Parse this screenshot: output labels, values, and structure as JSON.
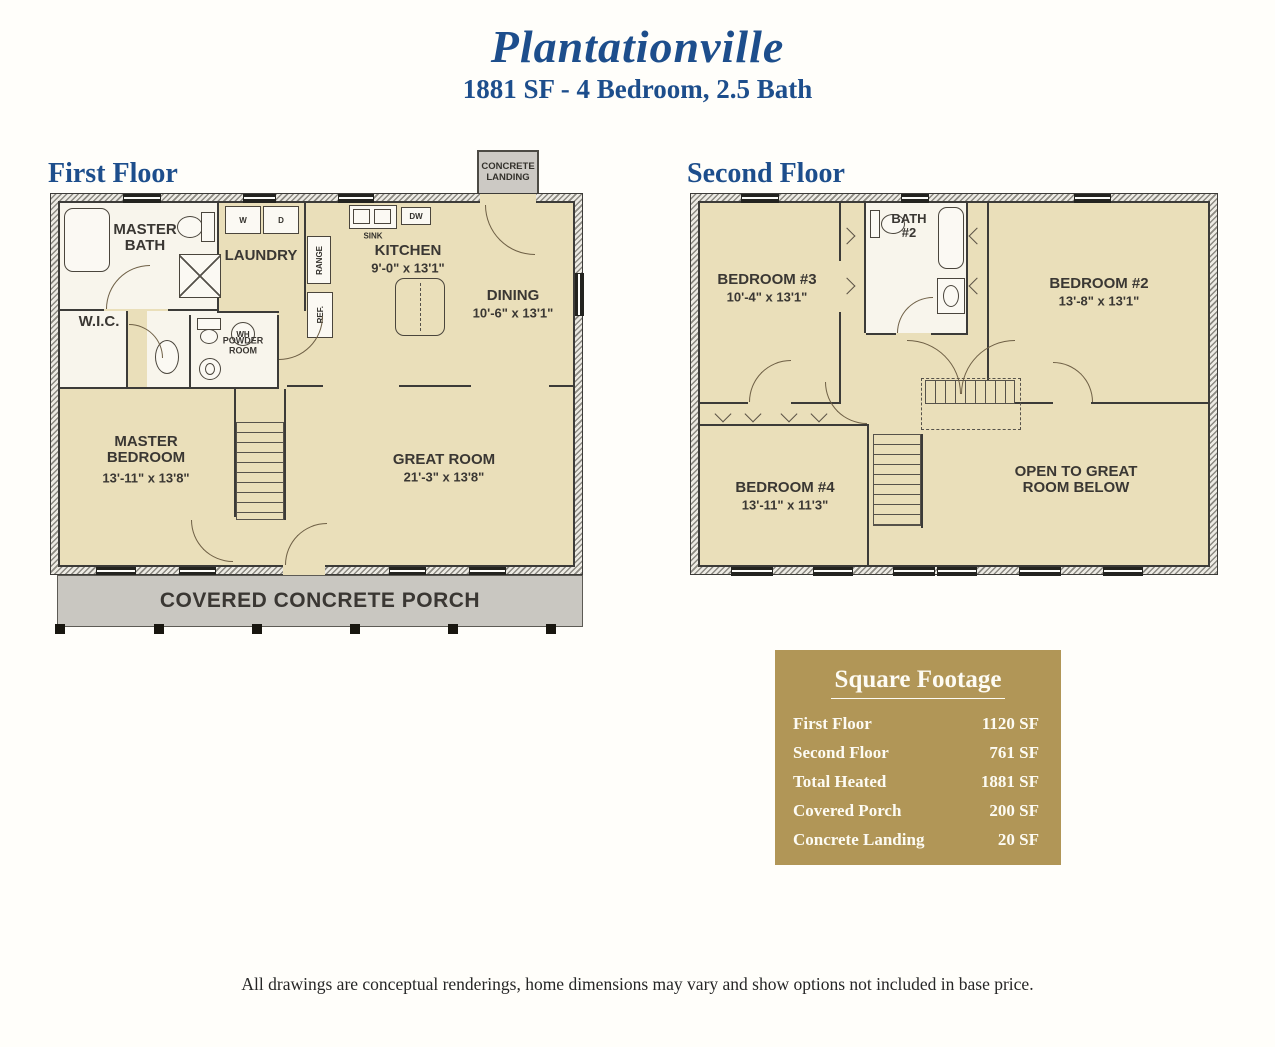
{
  "header": {
    "title": "Plantationville",
    "subtitle": "1881 SF - 4 Bedroom, 2.5 Bath"
  },
  "first_floor": {
    "label": "First Floor",
    "landing_label": "CONCRETE LANDING",
    "porch_label": "COVERED CONCRETE PORCH",
    "rooms": {
      "master_bath": {
        "name": "MASTER BATH"
      },
      "laundry": {
        "name": "LAUNDRY"
      },
      "wic": {
        "name": "W.I.C."
      },
      "powder_room": {
        "name": "POWDER ROOM"
      },
      "kitchen": {
        "name": "KITCHEN",
        "dims": "9'-0\" x 13'1\""
      },
      "dining": {
        "name": "DINING",
        "dims": "10'-6\" x 13'1\""
      },
      "master_bedroom": {
        "name": "MASTER BEDROOM",
        "dims": "13'-11\" x 13'8\""
      },
      "great_room": {
        "name": "GREAT ROOM",
        "dims": "21'-3\" x 13'8\""
      }
    },
    "fixtures": {
      "washer": "W",
      "dryer": "D",
      "water_heater": "WH",
      "sink": "SINK",
      "dishwasher": "DW",
      "range": "RANGE",
      "refrigerator": "REF."
    }
  },
  "second_floor": {
    "label": "Second Floor",
    "rooms": {
      "bedroom2": {
        "name": "BEDROOM #2",
        "dims": "13'-8\" x 13'1\""
      },
      "bedroom3": {
        "name": "BEDROOM #3",
        "dims": "10'-4\" x 13'1\""
      },
      "bedroom4": {
        "name": "BEDROOM #4",
        "dims": "13'-11\" x 11'3\""
      },
      "bath2": {
        "name": "BATH #2"
      },
      "open_below": {
        "name": "OPEN TO GREAT ROOM BELOW"
      }
    }
  },
  "square_footage": {
    "title": "Square Footage",
    "rows": [
      {
        "label": "First Floor",
        "value": "1120 SF"
      },
      {
        "label": "Second Floor",
        "value": "761 SF"
      },
      {
        "label": "Total Heated",
        "value": "1881 SF"
      },
      {
        "label": "Covered Porch",
        "value": "200 SF"
      },
      {
        "label": "Concrete Landing",
        "value": "20 SF"
      }
    ]
  },
  "disclaimer": "All drawings are conceptual renderings, home dimensions may vary and show options not included in base price.",
  "colors": {
    "accent_blue": "#1d4e8c",
    "room_tan": "#eadfba",
    "bath_white": "#f8f5ec",
    "wall": "#3c3b38",
    "concrete_gray": "#c9c7c1",
    "gold_panel": "#b19657"
  }
}
